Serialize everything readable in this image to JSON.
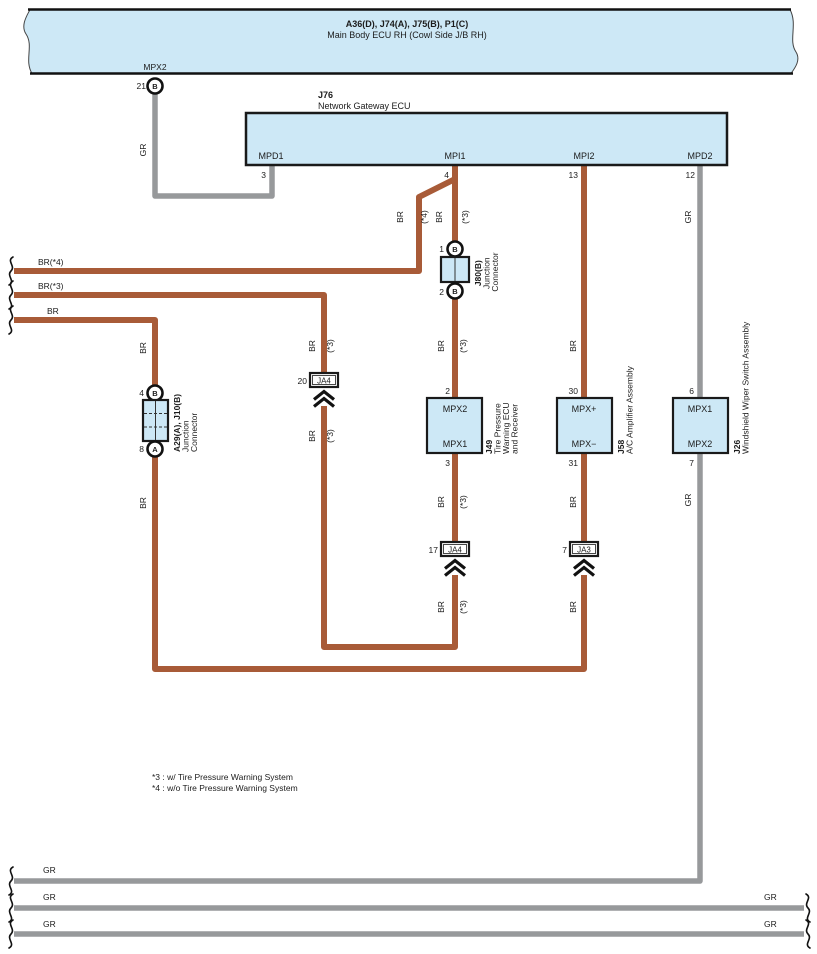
{
  "banner": {
    "title": "A36(D), J74(A), J75(B), P1(C)",
    "subtitle": "Main Body ECU RH (Cowl Side J/B RH)",
    "pin_label": "MPX2",
    "pin_number": "21",
    "pin_letter": "B"
  },
  "j76": {
    "id": "J76",
    "name": "Network Gateway ECU",
    "pins": [
      {
        "label": "MPD1",
        "num": "3"
      },
      {
        "label": "MPI1",
        "num": "4"
      },
      {
        "label": "MPI2",
        "num": "13"
      },
      {
        "label": "MPD2",
        "num": "12"
      }
    ]
  },
  "j80": {
    "id": "J80(B)",
    "line1": "Junction",
    "line2": "Connector",
    "pin1": "1",
    "pin1_letter": "B",
    "pin2": "2",
    "pin2_letter": "B"
  },
  "a29": {
    "id": "A29(A), J10(B)",
    "line1": "Junction",
    "line2": "Connector",
    "pin_top": "4",
    "pin_top_letter": "B",
    "pin_bottom": "8",
    "pin_bottom_letter": "A"
  },
  "j49": {
    "id": "J49",
    "line1": "Tire Pressure",
    "line2": "Warning ECU",
    "line3": "and Receiver",
    "pin_top": "2",
    "top_label": "MPX2",
    "pin_bottom": "3",
    "bottom_label": "MPX1"
  },
  "j58": {
    "id": "J58",
    "name": "A/C Amplifier Assembly",
    "pin_top": "30",
    "top_label": "MPX+",
    "pin_bottom": "31",
    "bottom_label": "MPX−"
  },
  "j26": {
    "id": "J26",
    "name": "Windshield Wiper Switch Assembly",
    "pin_top": "6",
    "top_label": "MPX1",
    "pin_bottom": "7",
    "bottom_label": "MPX2"
  },
  "relays": {
    "ja4_20": {
      "num": "20",
      "label": "JA4"
    },
    "ja4_17": {
      "num": "17",
      "label": "JA4"
    },
    "ja3_7": {
      "num": "7",
      "label": "JA3"
    }
  },
  "labels": {
    "gr": "GR",
    "br": "BR",
    "s3": "(*3)",
    "s4": "(*4)",
    "br4": "BR(*4)",
    "br3": "BR(*3)"
  },
  "notes": {
    "line1": "*3 : w/ Tire Pressure Warning System",
    "line2": "*4 : w/o Tire Pressure Warning System"
  },
  "colors": {
    "wire_brown": "#a85b38",
    "wire_gray": "#97999b",
    "component_fill": "#cde8f6",
    "outline": "#1a1a1a"
  }
}
